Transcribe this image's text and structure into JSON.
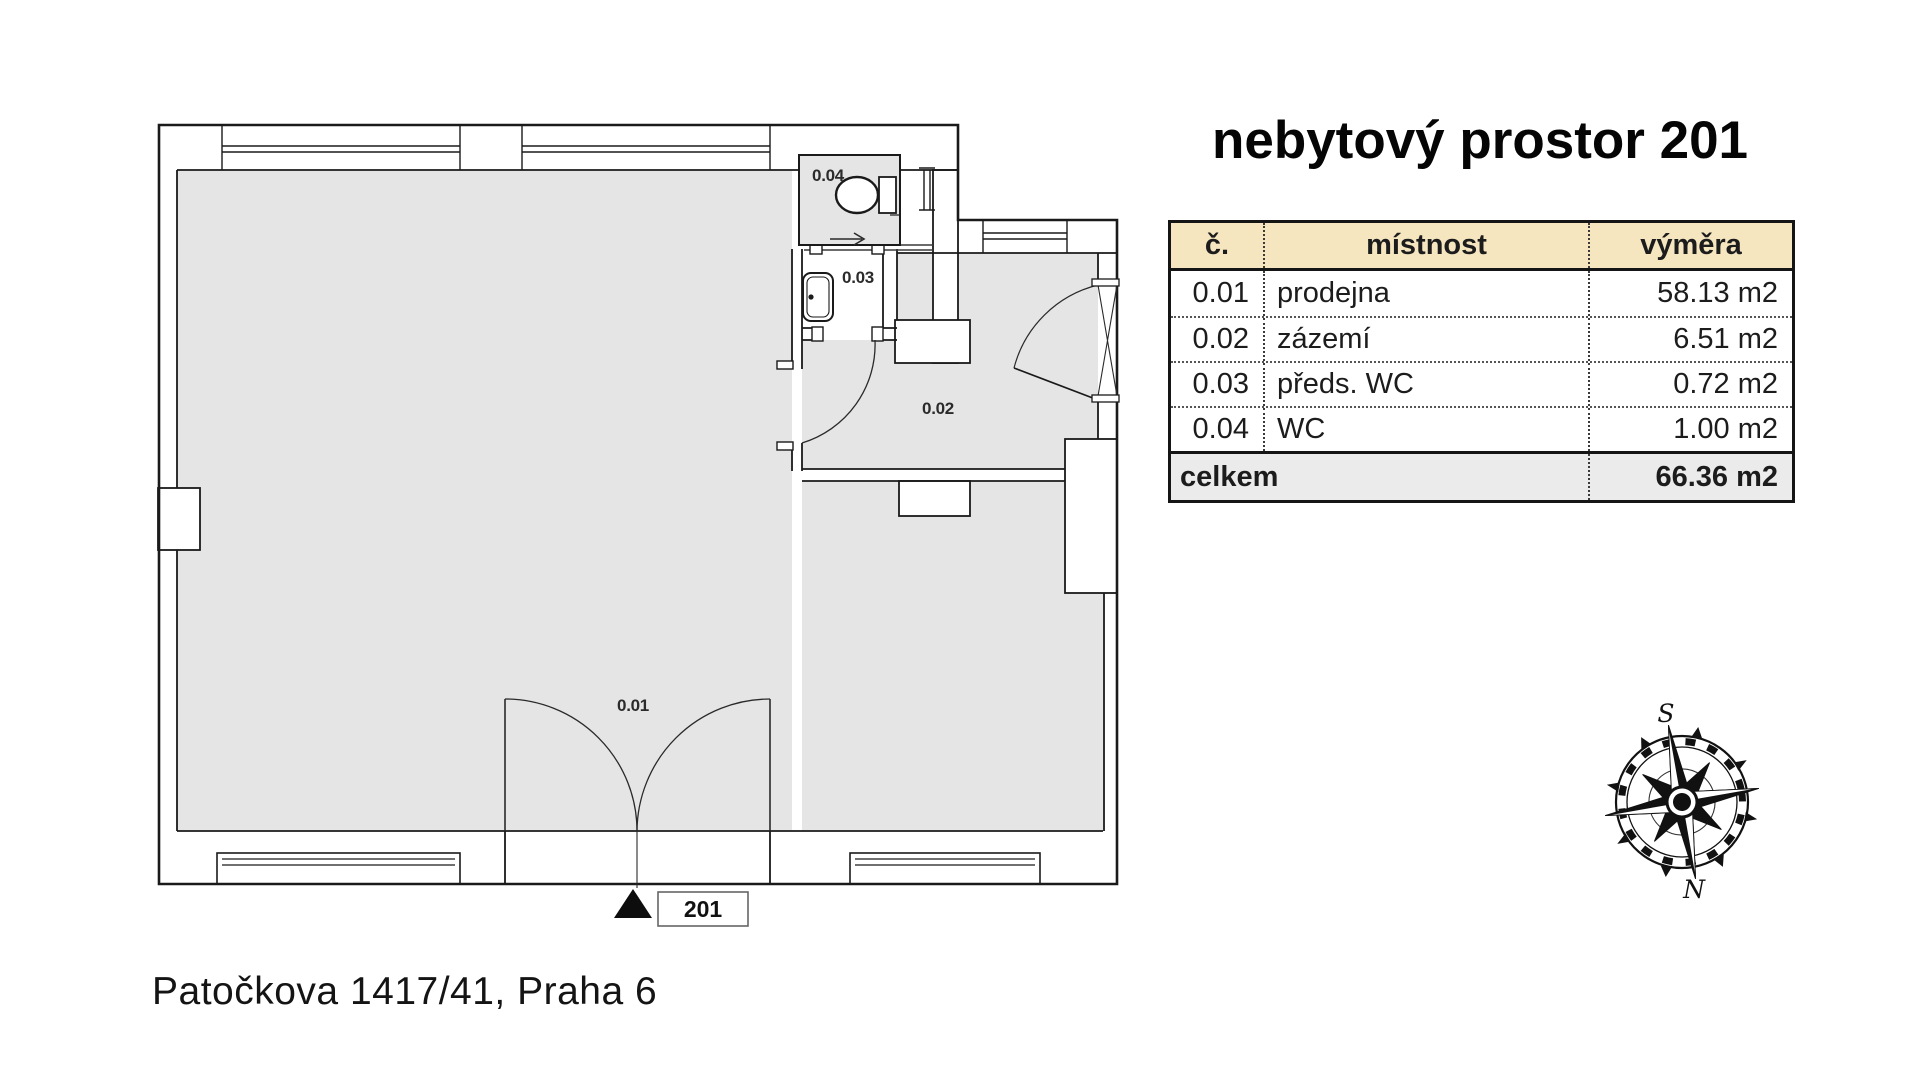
{
  "title": "nebytový prostor 201",
  "address": "Patočkova 1417/41, Praha 6",
  "table": {
    "headers": {
      "number": "č.",
      "room": "místnost",
      "area": "výměra"
    },
    "rows": [
      {
        "number": "0.01",
        "room": "prodejna",
        "area": "58.13 m2"
      },
      {
        "number": "0.02",
        "room": "zázemí",
        "area": "6.51 m2"
      },
      {
        "number": "0.03",
        "room": "předs. WC",
        "area": "0.72 m2"
      },
      {
        "number": "0.04",
        "room": "WC",
        "area": "1.00 m2"
      }
    ],
    "total": {
      "label": "celkem",
      "area": "66.36 m2"
    }
  },
  "floor_plan": {
    "room_labels": {
      "r001": "0.01",
      "r002": "0.02",
      "r003": "0.03",
      "r004": "0.04"
    },
    "entrance_label": "201"
  },
  "compass": {
    "south_label": "S",
    "north_label": "N"
  },
  "colors": {
    "floor_fill": "#e5e5e5",
    "wall_line": "#1a1a1a",
    "table_header_bg": "#f5e6bf",
    "table_total_bg": "#ebebeb"
  }
}
